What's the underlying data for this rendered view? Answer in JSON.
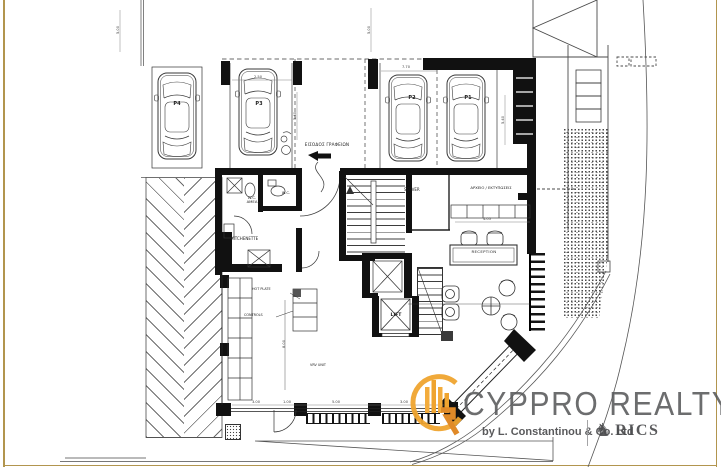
{
  "plan": {
    "parking": [
      "P4",
      "P3",
      "P2",
      "P1"
    ],
    "entrance_label": "ΕΙΣΟΔΟΣ ΓΡΑΦΕΙΩΝ",
    "rooms": {
      "wc_accessible_line1": "W.C.",
      "wc_accessible_line2": "ΑΜΕΑ",
      "wc": "W.C.",
      "kitchenette": "KITCHENETTE",
      "server": "SERVER",
      "archive": "ΑΡΧΕΙΟ / ΕΚΤΥΠΩΣΕΙΣ",
      "reception": "RECEPTION",
      "lift": "LIFT"
    },
    "annotations": {
      "hot_plate": "HOT PLATE",
      "controls": "CONTROLS",
      "vrv": "VRV UNIT"
    },
    "dimensions": [
      "5.00",
      "7.70",
      "2.50",
      "5.40",
      "5.40",
      "4.05",
      "8.00",
      "3.00",
      "1.00",
      "5.00",
      "3.00",
      "5.00"
    ]
  },
  "branding": {
    "name": "CYPPRO REALTY",
    "byline": "by L. Constantinou & Co. Ltd",
    "association": "RICS",
    "gold": "#EFA42F",
    "orange": "#E08A28",
    "gray": "#58595B"
  }
}
